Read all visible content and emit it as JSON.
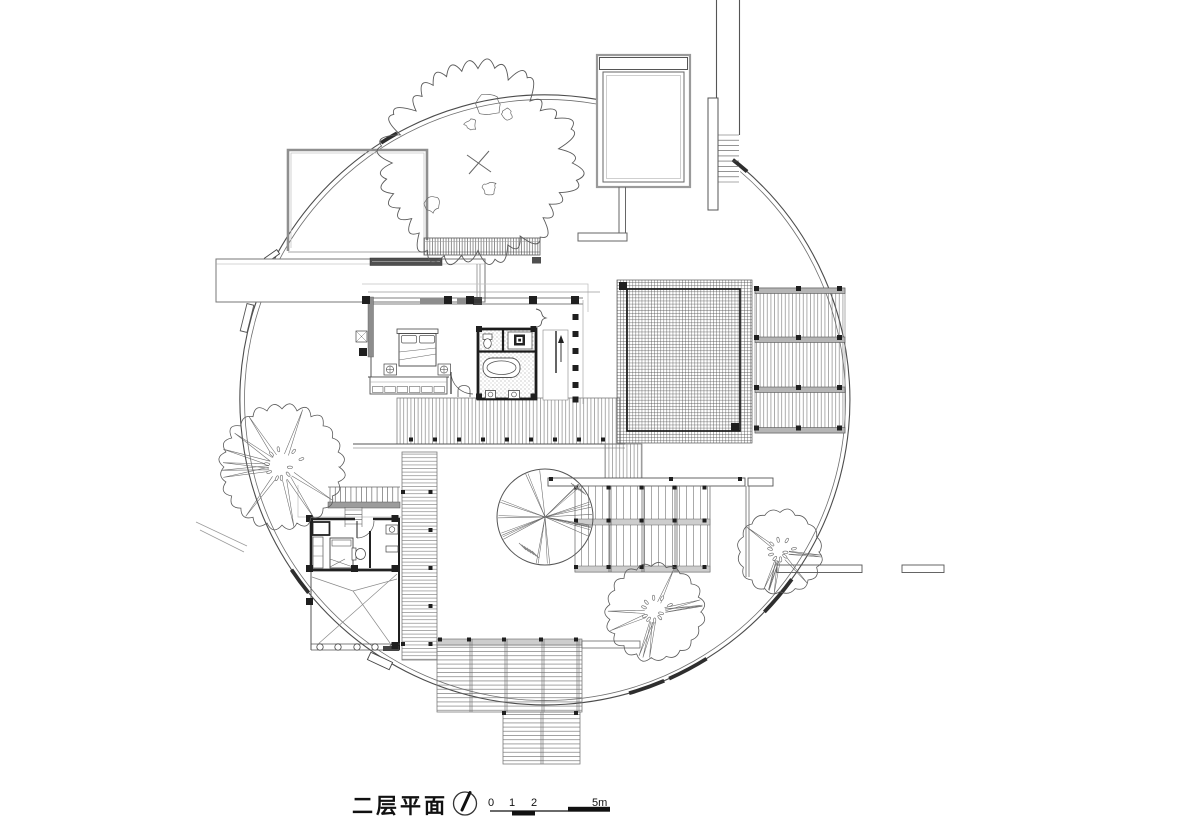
{
  "title_block": {
    "title": "二层平面",
    "scale_labels": [
      "0",
      "1",
      "2",
      "5m"
    ],
    "north_icon": "north-arrow-compass"
  },
  "colors": {
    "line": "#3a3a3a",
    "wall_dark": "#1f1f1f",
    "wall_gray": "#8c8c8c",
    "faint": "#c2c2c2",
    "paper": "#ffffff"
  },
  "site": {
    "circle": {
      "cx": 545,
      "cy": 400,
      "r_outer": 305,
      "r_inner": 300.5,
      "gap_start_deg": 80,
      "gap_end_deg": 49.5
    },
    "thick_segments_deg": [
      [
        52,
        48.5
      ],
      [
        -74,
        -67
      ],
      [
        -66,
        -58
      ],
      [
        -44,
        -36
      ],
      [
        122.5,
        119
      ],
      [
        -146.2,
        -140.8
      ]
    ]
  },
  "trees": [
    {
      "type": "deciduous",
      "cx": 478,
      "cy": 163,
      "r": 100
    },
    {
      "type": "palm",
      "cx": 282,
      "cy": 467,
      "r": 66
    },
    {
      "type": "palm",
      "cx": 655,
      "cy": 612,
      "r": 52
    },
    {
      "type": "palm",
      "cx": 780,
      "cy": 552,
      "r": 45
    },
    {
      "type": "radial",
      "cx": 545,
      "cy": 517,
      "r": 48
    }
  ],
  "ladders": [
    {
      "name": "stair-main-treads",
      "x": 543.5,
      "y": 333,
      "w": 24,
      "h": 66,
      "n": 14,
      "dir": "h"
    },
    {
      "name": "stair-guest-treads",
      "x": 330,
      "y": 487,
      "w": 68,
      "h": 15,
      "n": 14,
      "dir": "v"
    },
    {
      "name": "stair-guest-lower",
      "x": 345,
      "y": 510,
      "w": 17,
      "h": 14,
      "n": 4,
      "dir": "h"
    },
    {
      "name": "path-steps-ne",
      "x": 718,
      "y": 135,
      "w": 21,
      "h": 47,
      "n": 10,
      "dir": "h"
    }
  ],
  "nodes": {
    "s4": [
      [
        409,
        437.5
      ],
      [
        433,
        437.5
      ],
      [
        457,
        437.5
      ],
      [
        481,
        437.5
      ],
      [
        505,
        437.5
      ],
      [
        529,
        437.5
      ],
      [
        553,
        437.5
      ],
      [
        577,
        437.5
      ],
      [
        601,
        437.5
      ],
      [
        549,
        477
      ],
      [
        669,
        477
      ],
      [
        738,
        477
      ],
      [
        574,
        485.5
      ],
      [
        606.5,
        485.5
      ],
      [
        639.5,
        485.5
      ],
      [
        672.5,
        485.5
      ],
      [
        702.5,
        485.5
      ],
      [
        574,
        518.5
      ],
      [
        606.5,
        518.5
      ],
      [
        639.5,
        518.5
      ],
      [
        672.5,
        518.5
      ],
      [
        702.5,
        518.5
      ],
      [
        574,
        565
      ],
      [
        606.5,
        565
      ],
      [
        639.5,
        565
      ],
      [
        672.5,
        565
      ],
      [
        702.5,
        565
      ],
      [
        428.5,
        490
      ],
      [
        428.5,
        528
      ],
      [
        428.5,
        566
      ],
      [
        428.5,
        604
      ],
      [
        428.5,
        642
      ],
      [
        401,
        490
      ],
      [
        401,
        642
      ],
      [
        438,
        637.5
      ],
      [
        467,
        637.5
      ],
      [
        502,
        637.5
      ],
      [
        539,
        637.5
      ],
      [
        574,
        637.5
      ],
      [
        502,
        711
      ],
      [
        574,
        711
      ]
    ],
    "s5": [
      [
        754,
        286
      ],
      [
        796,
        286
      ],
      [
        837,
        286
      ],
      [
        754,
        335
      ],
      [
        796,
        335
      ],
      [
        837,
        335
      ],
      [
        754,
        385
      ],
      [
        796,
        385
      ],
      [
        837,
        385
      ],
      [
        754,
        425.5
      ],
      [
        796,
        425.5
      ],
      [
        837,
        425.5
      ]
    ],
    "s6": [
      [
        476,
        326
      ],
      [
        530.5,
        326
      ],
      [
        476,
        393.5
      ],
      [
        530.5,
        393.5
      ],
      [
        572.5,
        297
      ],
      [
        572.5,
        314
      ],
      [
        572.5,
        331
      ],
      [
        572.5,
        348
      ],
      [
        572.5,
        365
      ],
      [
        572.5,
        382
      ],
      [
        572.5,
        396.5
      ]
    ],
    "s8": [
      [
        362,
        296
      ],
      [
        444,
        296
      ],
      [
        466,
        296
      ],
      [
        529,
        296
      ],
      [
        571,
        296
      ],
      [
        359,
        348
      ],
      [
        619,
        282
      ],
      [
        731,
        423
      ]
    ],
    "s7": [
      [
        306,
        515
      ],
      [
        391.5,
        515
      ],
      [
        306,
        565
      ],
      [
        351,
        565
      ],
      [
        391.5,
        565
      ],
      [
        306,
        598
      ],
      [
        391.5,
        642
      ]
    ]
  }
}
